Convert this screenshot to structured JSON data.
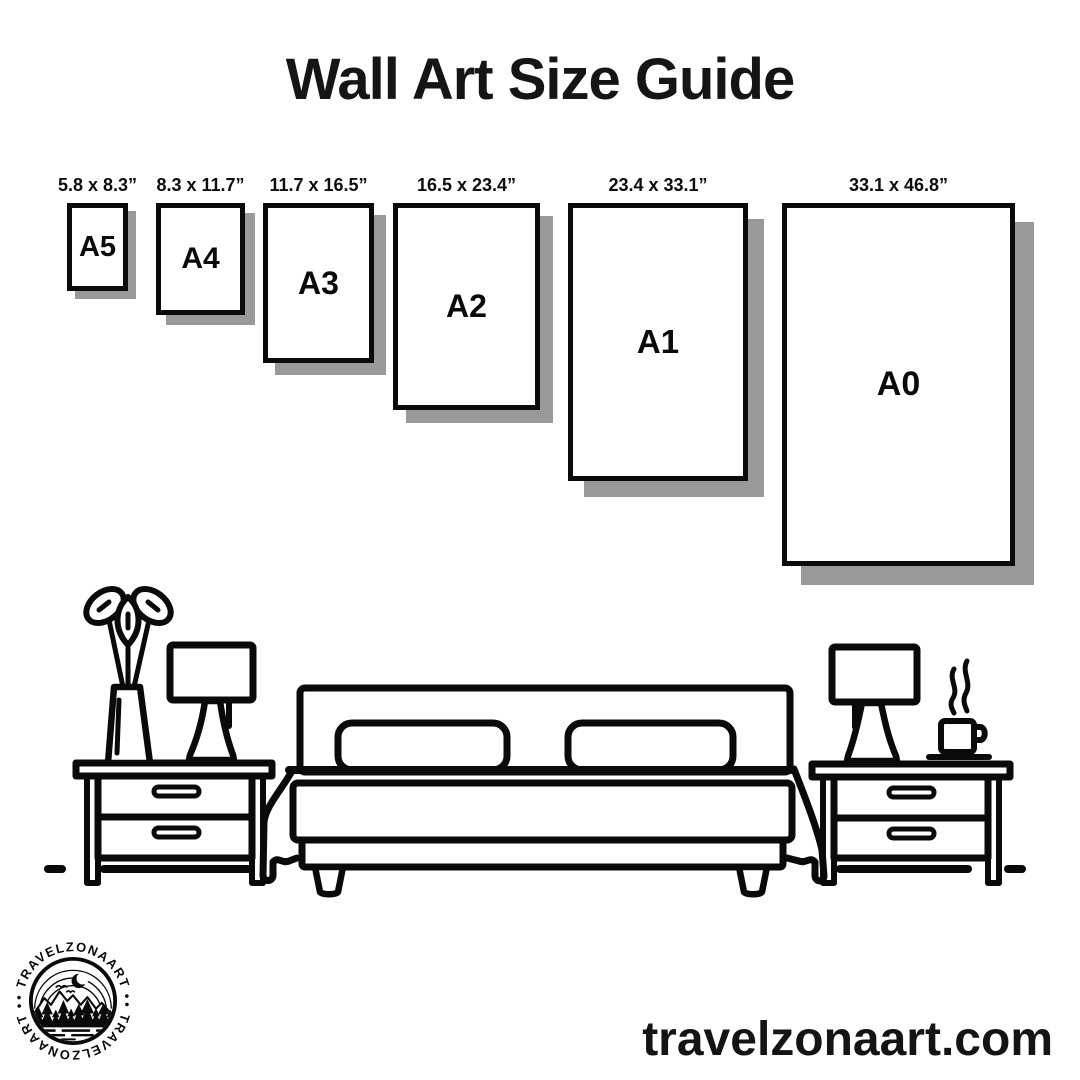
{
  "title": "Wall Art Size Guide",
  "sizes": [
    {
      "name": "A5",
      "dims": "5.8 x 8.3”"
    },
    {
      "name": "A4",
      "dims": "8.3 x 11.7”"
    },
    {
      "name": "A3",
      "dims": "11.7 x 16.5”"
    },
    {
      "name": "A2",
      "dims": "16.5 x 23.4”"
    },
    {
      "name": "A1",
      "dims": "23.4 x 33.1”"
    },
    {
      "name": "A0",
      "dims": "33.1 x 46.8”"
    }
  ],
  "footer": {
    "website": "travelzonaart.com"
  },
  "logo": {
    "ring_text": "• TRAVELZONAART •"
  },
  "icons": {
    "furniture": [
      "potted-plant",
      "table-lamp",
      "nightstand",
      "double-bed",
      "pillow",
      "coffee-cup"
    ],
    "logo_motifs": [
      "crescent-moon",
      "mountain-range",
      "pine-trees",
      "birds",
      "lake-water"
    ]
  },
  "colors": {
    "ink": "#0a0a0a",
    "paper_fill": "#ffffff",
    "paper_shadow": "#999999",
    "background": "#ffffff"
  }
}
